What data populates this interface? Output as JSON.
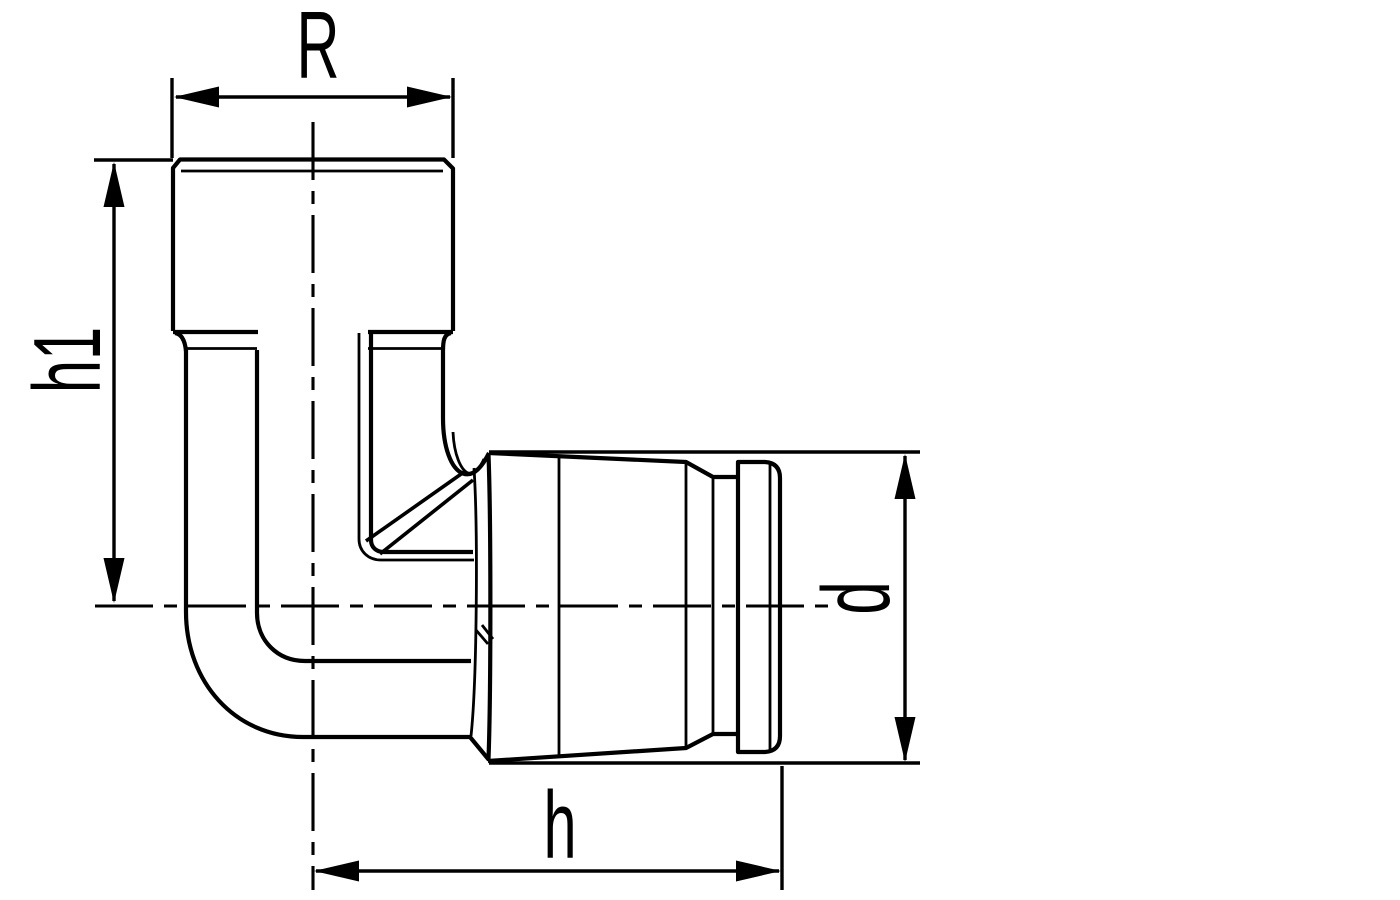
{
  "drawing": {
    "labels": {
      "top_width": "R",
      "left_height": "h1",
      "bottom_length": "h",
      "right_diameter": "d"
    },
    "colors": {
      "line": "#000000",
      "background": "#ffffff"
    }
  }
}
